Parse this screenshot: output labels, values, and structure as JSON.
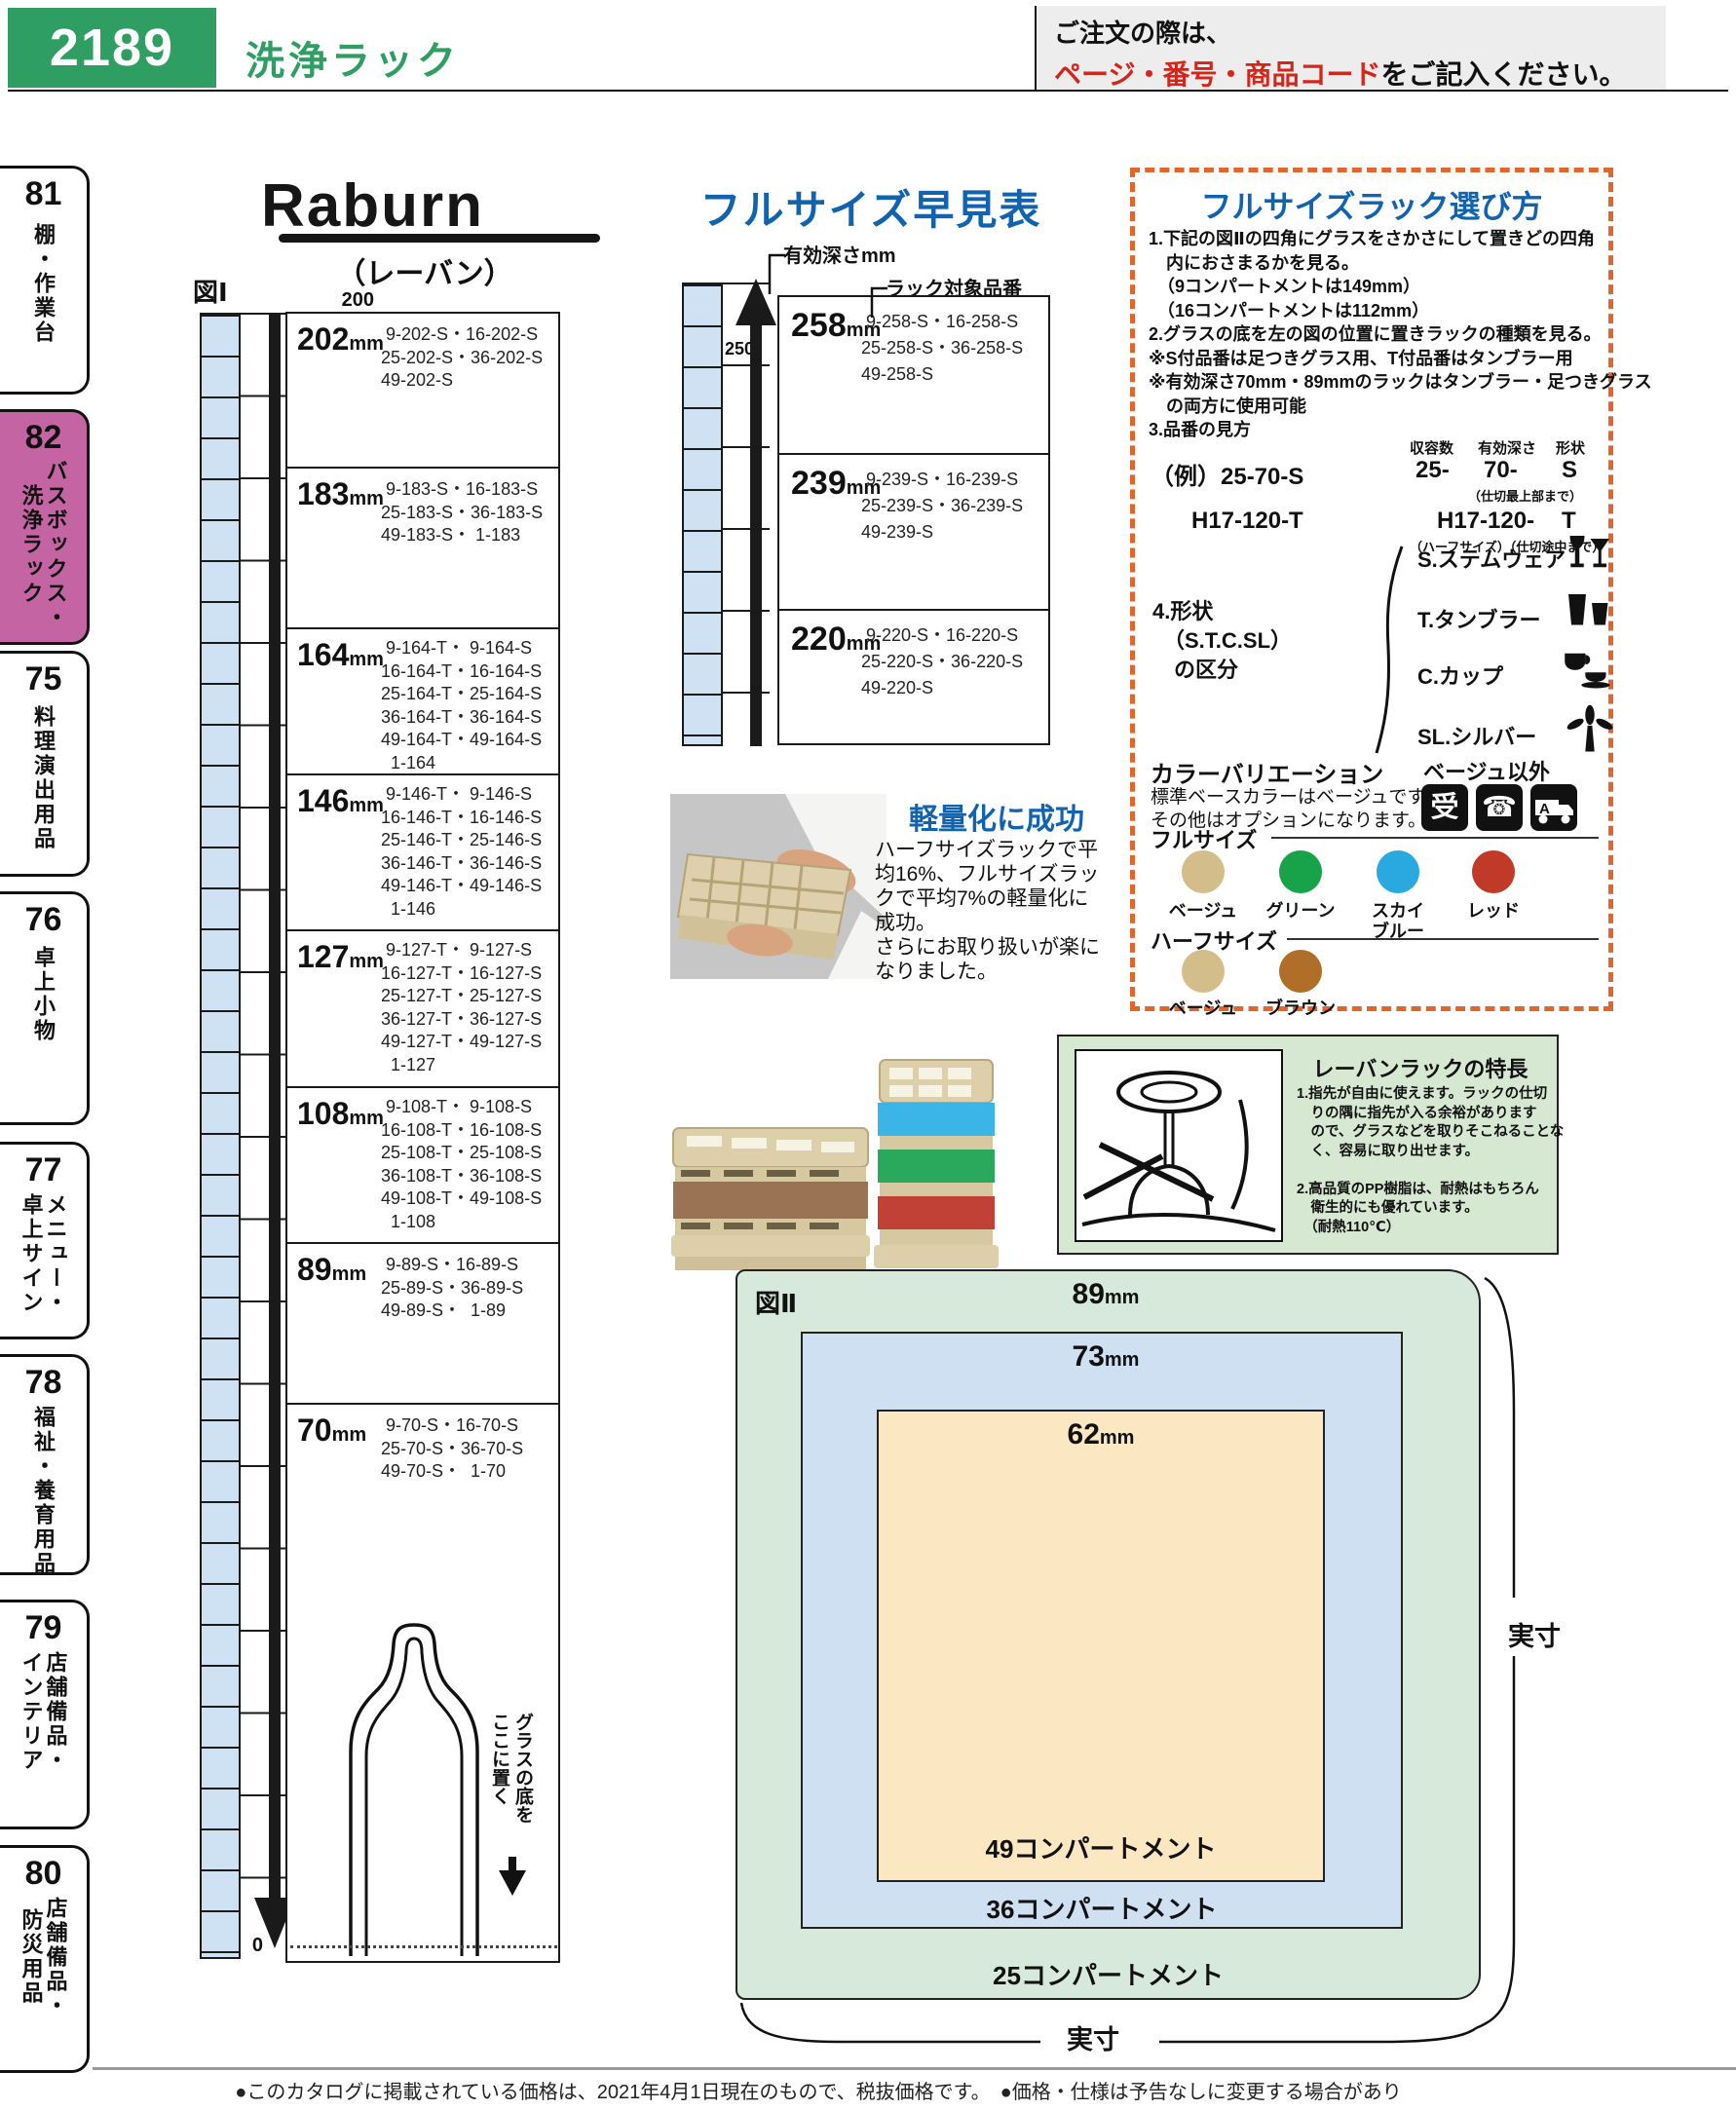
{
  "page": {
    "code": "2189",
    "title": "洗浄ラック",
    "order_line1": "ご注文の際は、",
    "order_red": "ページ・番号・商品コード",
    "order_line2": "をご記入ください。",
    "footer": "●このカタログに掲載されている価格は、2021年4月1日現在のもので、税抜価格です。　●価格・仕様は予告なしに変更する場合があります。予めご了承ください。",
    "palette": {
      "header_green": "#2e9e62",
      "accent_blue": "#1263ae",
      "accent_red": "#d3261c",
      "active_tab_pink": "#c464a2",
      "dashed_border_orange": "#e0662e",
      "ruler_blue": "#cfe2f4",
      "fig2_green": "#d6e9da",
      "fig2_blue": "#cfe0f2",
      "fig2_orange": "#fbe7c1"
    }
  },
  "sidebar": {
    "tabs": [
      {
        "num": "81",
        "label": "棚・作業台"
      },
      {
        "num": "82",
        "label": "バスボックス・洗浄ラック"
      },
      {
        "num": "75",
        "label": "料理演出用品"
      },
      {
        "num": "76",
        "label": "卓上小物"
      },
      {
        "num": "77",
        "label": "メニュー・卓上サイン"
      },
      {
        "num": "78",
        "label": "福祉・養育用品"
      },
      {
        "num": "79",
        "label": "店舗備品・インテリア"
      },
      {
        "num": "80",
        "label": "店舗備品・防災用品"
      }
    ]
  },
  "brand": {
    "logo": "Raburn",
    "reading": "（レーバン）"
  },
  "fig1": {
    "label": "図Ⅰ",
    "ticks": [
      "200",
      "150",
      "100",
      "50",
      "0"
    ],
    "glass_note": "グラスの底を\nここに置く",
    "rows": [
      {
        "num": "202",
        "unit": "mm",
        "codes": " 9-202-S・16-202-S\n25-202-S・36-202-S\n49-202-S"
      },
      {
        "num": "183",
        "unit": "mm",
        "codes": " 9-183-S・16-183-S\n25-183-S・36-183-S\n49-183-S・ 1-183"
      },
      {
        "num": "164",
        "unit": "mm",
        "codes": " 9-164-T・ 9-164-S\n16-164-T・16-164-S\n25-164-T・25-164-S\n36-164-T・36-164-S\n49-164-T・49-164-S\n  1-164"
      },
      {
        "num": "146",
        "unit": "mm",
        "codes": " 9-146-T・ 9-146-S\n16-146-T・16-146-S\n25-146-T・25-146-S\n36-146-T・36-146-S\n49-146-T・49-146-S\n  1-146"
      },
      {
        "num": "127",
        "unit": "mm",
        "codes": " 9-127-T・ 9-127-S\n16-127-T・16-127-S\n25-127-T・25-127-S\n36-127-T・36-127-S\n49-127-T・49-127-S\n  1-127"
      },
      {
        "num": "108",
        "unit": "mm",
        "codes": " 9-108-T・ 9-108-S\n16-108-T・16-108-S\n25-108-T・25-108-S\n36-108-T・36-108-S\n49-108-T・49-108-S\n  1-108"
      },
      {
        "num": "89",
        "unit": "mm",
        "codes": " 9-89-S・16-89-S\n25-89-S・36-89-S\n49-89-S・  1-89"
      },
      {
        "num": "70",
        "unit": "mm",
        "codes": " 9-70-S・16-70-S\n25-70-S・36-70-S\n49-70-S・  1-70"
      }
    ]
  },
  "quickref": {
    "title": "フルサイズ早見表",
    "depth_label": "有効深さmm",
    "target_label": "ラック対象品番",
    "tick": "250",
    "rows": [
      {
        "num": "258",
        "unit": "mm",
        "codes": " 9-258-S・16-258-S\n25-258-S・36-258-S\n49-258-S"
      },
      {
        "num": "239",
        "unit": "mm",
        "codes": " 9-239-S・16-239-S\n25-239-S・36-239-S\n49-239-S"
      },
      {
        "num": "220",
        "unit": "mm",
        "codes": " 9-220-S・16-220-S\n25-220-S・36-220-S\n49-220-S"
      }
    ]
  },
  "howto": {
    "title": "フルサイズラック選び方",
    "steps": "1.下記の図Ⅱの四角にグラスをさかさにして置きどの四角\n　内におさまるかを見る。\n　（9コンパートメントは149mm）\n　（16コンパートメントは112mm）\n2.グラスの底を左の図の位置に置きラックの種類を見る。\n※S付品番は足つきグラス用、T付品番はタンブラー用\n※有効深さ70mm・89mmのラックはタンブラー・足つきグラス\n　の両方に使用可能\n3.品番の見方",
    "example": {
      "h_capacity": "収容数",
      "h_depth": "有効深さ",
      "h_shape": "形状",
      "r1_code": "（例）25-70-S",
      "r1_capacity": "25-",
      "r1_depth": "70-",
      "r1_shape": "S",
      "r1_note": "（仕切最上部まで）",
      "r2_code": "H17-120-T",
      "r2_val": "H17-120-",
      "r2_shape": "T",
      "r2_note": "（ハーフサイズ）（仕切途中まで）"
    },
    "shape_label": "4.形状\n　（S.T.C.SL）\n　の区分",
    "shapes": [
      {
        "label": "S.ステムウェア"
      },
      {
        "label": "T.タンブラー"
      },
      {
        "label": "C.カップ"
      },
      {
        "label": "SL.シルバー"
      }
    ],
    "colors": {
      "title": "カラーバリエーション",
      "note": "標準ベースカラーはベージュです。\nその他はオプションになります。",
      "other": "ベージュ以外",
      "accept_icon": "受",
      "phone_icon": "☎",
      "truck_icon": "A",
      "full_label": "フルサイズ",
      "half_label": "ハーフサイズ",
      "full": [
        {
          "name": "ベージュ",
          "hex": "#d3bd8a"
        },
        {
          "name": "グリーン",
          "hex": "#18a34b"
        },
        {
          "name": "スカイ\nブルー",
          "hex": "#2aa9e1"
        },
        {
          "name": "レッド",
          "hex": "#c13a28"
        }
      ],
      "half": [
        {
          "name": "ベージュ",
          "hex": "#d3bd8a"
        },
        {
          "name": "ブラウン",
          "hex": "#b06f28"
        }
      ]
    }
  },
  "lightweight": {
    "title": "軽量化に成功",
    "body": "ハーフサイズラックで平\n均16%、フルサイズラッ\nクで平均7%の軽量化に\n成功。\nさらにお取り扱いが楽に\nなりました。"
  },
  "features": {
    "title": "レーバンラックの特長",
    "body": "1.指先が自由に使えます。ラックの仕切\n　りの隅に指先が入る余裕があります\n　ので、グラスなどを取りそこねることな\n　く、容易に取り出せます。\n\n2.高品質のPP樹脂は、耐熱はもちろん\n　衛生的にも優れています。\n　（耐熱110℃）"
  },
  "fig2": {
    "label": "図Ⅱ",
    "outer_size": "89",
    "middle_size": "73",
    "inner_size": "62",
    "unit": "mm",
    "inner_label": "49コンパートメント",
    "middle_label": "36コンパートメント",
    "outer_label": "25コンパートメント",
    "actual": "実寸"
  }
}
